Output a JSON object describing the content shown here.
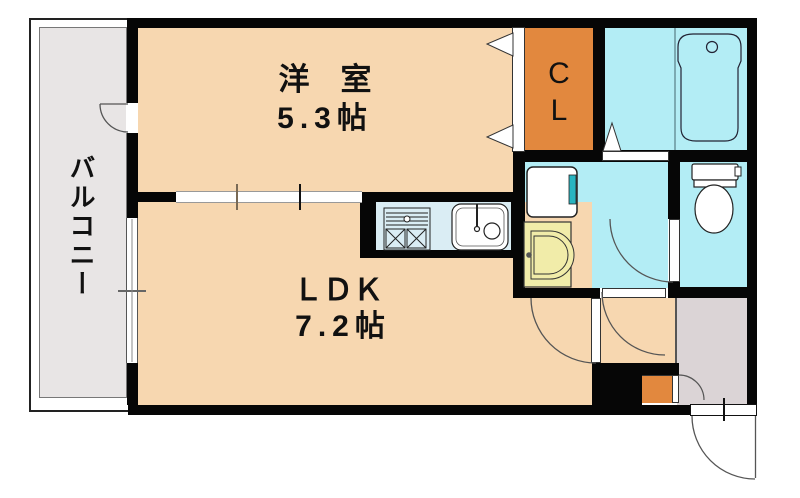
{
  "title": "1LDK floor plan",
  "rooms": {
    "western_room": {
      "name": "洋　室",
      "size": "5.3帖"
    },
    "ldk": {
      "name": "ＬＤＫ",
      "size": "7.2帖"
    },
    "closet": {
      "line1": "C",
      "line2": "L"
    },
    "balcony": {
      "name": "バルコニー"
    }
  },
  "icons": [
    "stove-icon",
    "sink-icon",
    "washing-machine-icon",
    "washbasin-icon",
    "bathtub-icon",
    "toilet-icon",
    "door-swing-arc"
  ],
  "colors": {
    "room_peach": "#f7d7b0",
    "closet_orange": "#e2883e",
    "wet_cyan": "#b3edf5",
    "counter_blue": "#daedf4",
    "basin_yellow": "#f1eca9",
    "teal_accent": "#28b4c0",
    "balcony_gray": "#e8e5e5",
    "genkan_gray": "#dbd4d6",
    "wall_black": "#060606"
  }
}
